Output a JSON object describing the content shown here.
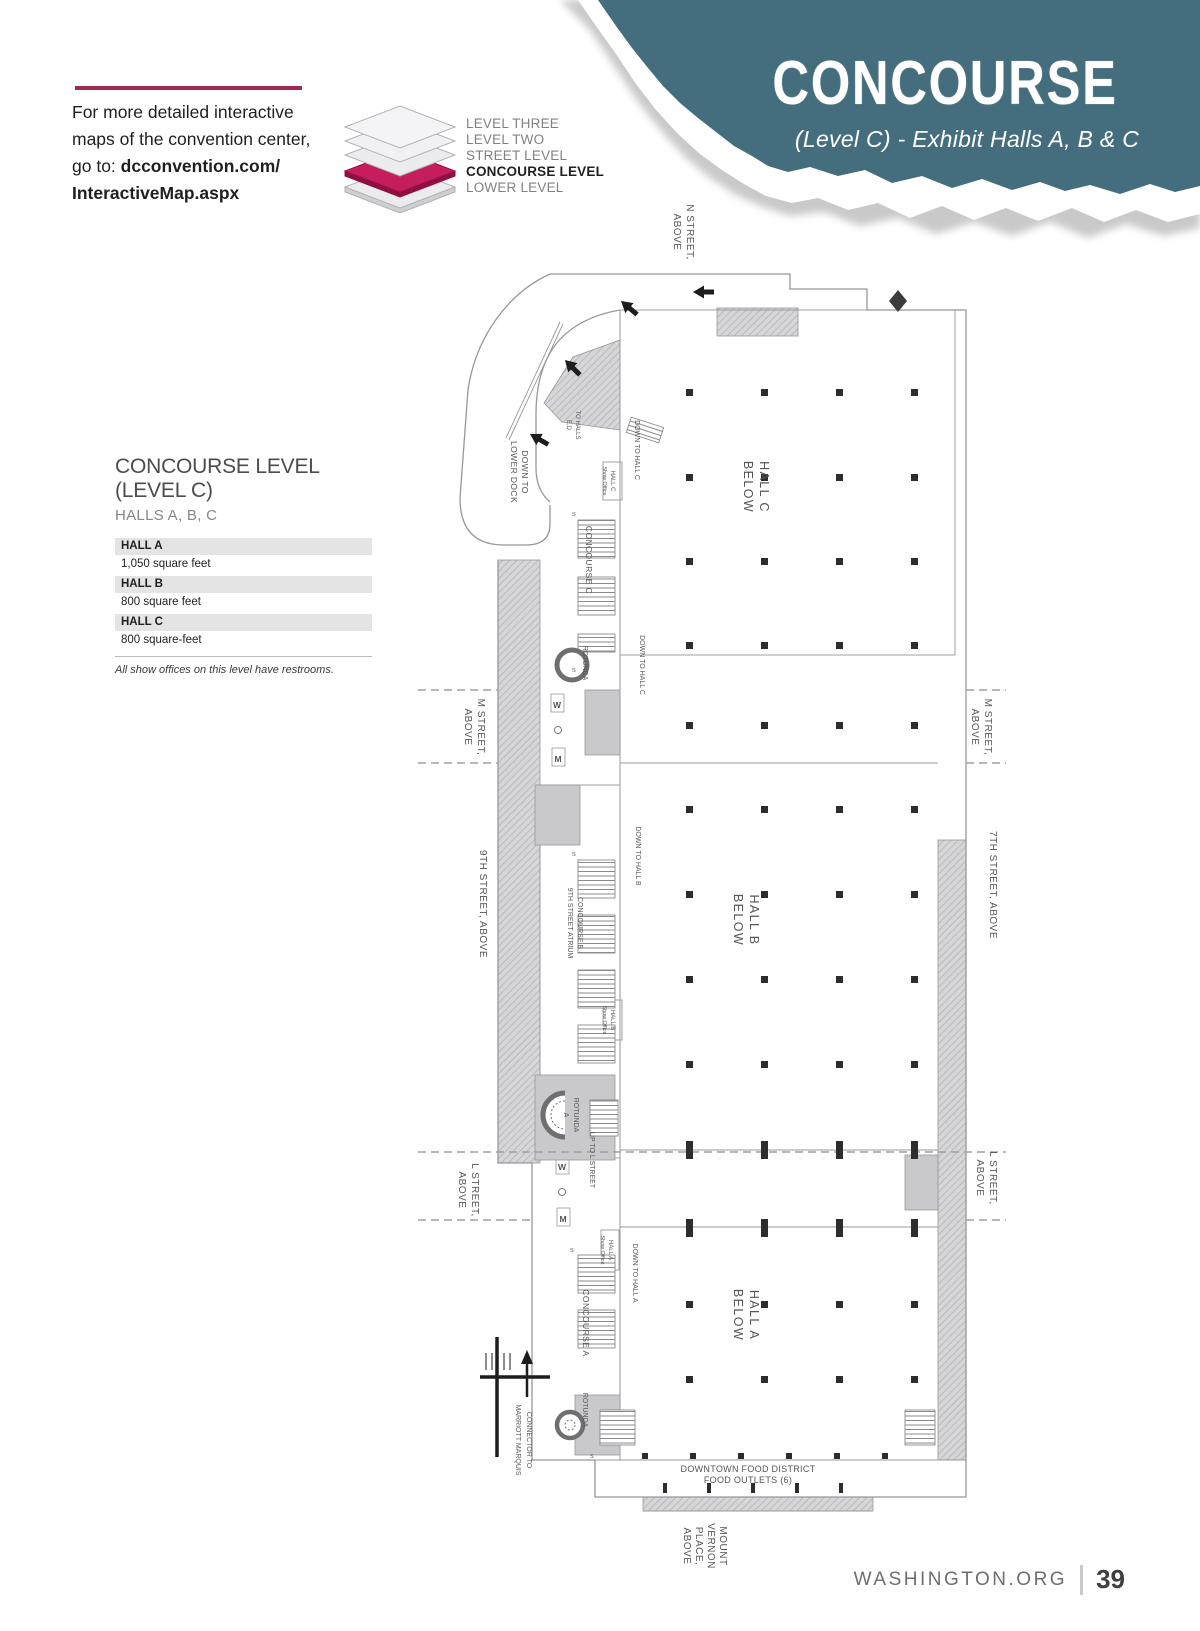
{
  "banner": {
    "title": "CONCOURSE",
    "subtitle": "(Level C) - Exhibit Halls A, B & C",
    "bg_color": "#446e7d",
    "text_color": "#ffffff"
  },
  "promo": {
    "line1": "For more detailed interactive",
    "line2": "maps of the convention center,",
    "line3_prefix": "go to: ",
    "line3_bold": "dcconvention.com/",
    "line4_bold": "InteractiveMap.aspx",
    "rule_color": "#a12a52"
  },
  "level_key": {
    "level_three": "LEVEL THREE",
    "level_two": "LEVEL TWO",
    "street": "STREET LEVEL",
    "concourse": "CONCOURSE LEVEL",
    "lower": "LOWER LEVEL",
    "highlight_color": "#c51d5e"
  },
  "info": {
    "title": "CONCOURSE LEVEL (LEVEL C)",
    "subtitle": "HALLS A, B, C",
    "halls": [
      {
        "name": "HALL A",
        "size": "1,050 square feet"
      },
      {
        "name": "HALL B",
        "size": "800 square feet"
      },
      {
        "name": "HALL C",
        "size": "800 square-feet"
      }
    ],
    "note": "All show offices on this level have restrooms."
  },
  "map": {
    "compass": "N",
    "labels": {
      "n_street": [
        "N STREET,",
        "ABOVE"
      ],
      "m_street": [
        "M STREET,",
        "ABOVE"
      ],
      "l_street": [
        "L STREET,",
        "ABOVE"
      ],
      "ninth_street": "9TH STREET, ABOVE",
      "seventh_street": "7TH STREET, ABOVE",
      "mount_vernon": [
        "MOUNT",
        "VERNON",
        "PLACE,",
        "ABOVE"
      ],
      "hall_c_below": [
        "HALL C",
        "BELOW"
      ],
      "hall_b_below": [
        "HALL B",
        "BELOW"
      ],
      "hall_a_below": [
        "HALL A",
        "BELOW"
      ],
      "concourse_c": "CONCOURSE C",
      "concourse_b": [
        "CONCOURSE B",
        "9TH STREET ATRIUM"
      ],
      "concourse_a": "CONCOURSE A",
      "down_to_hall_c": "DOWN TO HALL C",
      "down_to_hall_b": "DOWN TO HALL B",
      "down_to_hall_a": "DOWN TO HALL A",
      "down_to_lower_dock": [
        "DOWN TO",
        "LOWER DOCK"
      ],
      "to_halls": [
        "TO HALLS",
        "E,D"
      ],
      "up_to_l_street": "UP TO L STREET",
      "rotunda": "ROTUNDA",
      "rotunda_a": [
        "ROTUNDA",
        "A"
      ],
      "connector": [
        "CONNECTOR TO",
        "MARRIOTT MARQUIS"
      ],
      "food_district": [
        "DOWNTOWN FOOD DISTRICT",
        "FOOD OUTLETS (6)"
      ],
      "hall_c_office": [
        "HALL C",
        "Show Office"
      ],
      "hall_b_office": [
        "HALL B",
        "Show Office"
      ],
      "hall_a_office": [
        "HALL A",
        "Show Office"
      ],
      "restroom_w": "W",
      "restroom_m": "M",
      "stairs": "S"
    }
  },
  "footer": {
    "site": "WASHINGTON.ORG",
    "page_number": "39"
  }
}
